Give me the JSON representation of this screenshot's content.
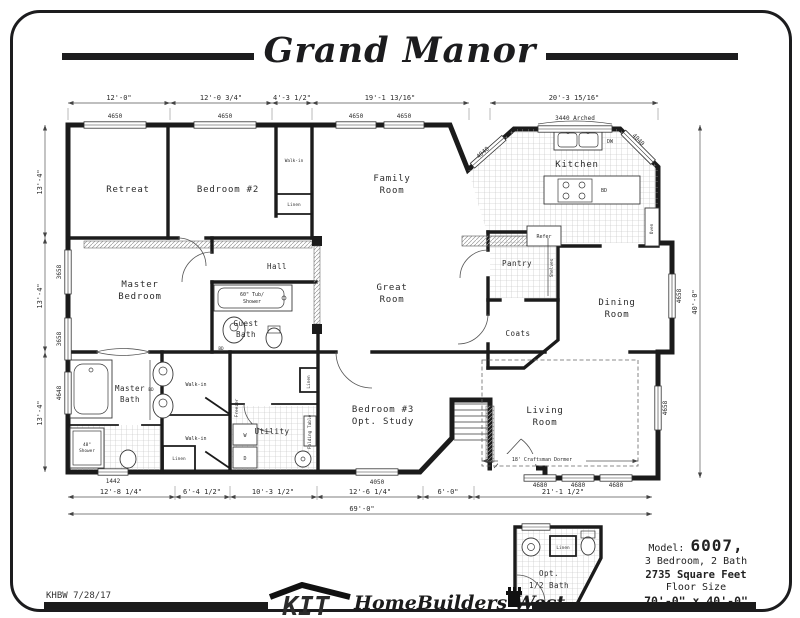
{
  "title": "Grand Manor",
  "footer": {
    "code": "KHBW 7/28/17",
    "brand": "KIT",
    "brand_name": "HomeBuilders West"
  },
  "info": {
    "model_label": "Model:",
    "model_number": "6007,",
    "line2": "3 Bedroom, 2 Bath",
    "line3": "2735 Square Feet",
    "line4": "Floor Size",
    "line5": "70'-0\" x 40'-0\""
  },
  "rooms": {
    "retreat": "Retreat",
    "bedroom2": "Bedroom #2",
    "family": [
      "Family",
      "Room"
    ],
    "kitchen": "Kitchen",
    "hall": "Hall",
    "master_bedroom": [
      "Master",
      "Bedroom"
    ],
    "guest_bath": [
      "Guest",
      "Bath"
    ],
    "great": [
      "Great",
      "Room"
    ],
    "pantry": "Pantry",
    "dining": [
      "Dining",
      "Room"
    ],
    "coats": "Coats",
    "master_bath": [
      "Master",
      "Bath"
    ],
    "utility": "Utility",
    "bedroom3": [
      "Bedroom #3",
      "Opt. Study"
    ],
    "living": [
      "Living",
      "Room"
    ],
    "half_bath": [
      "Opt.",
      "1/2 Bath"
    ]
  },
  "fixtures": {
    "walk_in": "Walk-in",
    "linen": "Linen",
    "refer": "Refer",
    "dw": "DW",
    "bd": "BD",
    "tub_label": [
      "60\" Tub/",
      "Shower"
    ],
    "shower_label": [
      "48\"",
      "Shower"
    ],
    "freezer": "Freezer",
    "folding_table": "Folding Table",
    "washer": "W",
    "dryer": "D",
    "shelves": "Shelves",
    "oven": "Oven",
    "dormer": "18' Craftsman Dormer",
    "arched": "3440 Arched"
  },
  "windows": {
    "w4650": "4650",
    "w4040": "4040",
    "w3658": "3658",
    "w4648": "4648",
    "w4658": "4658",
    "w4680": "4680",
    "w4050": "4050",
    "w1442": "1442"
  },
  "dims": {
    "top": [
      "12'-0\"",
      "12'-0 3/4\"",
      "4'-3 1/2\"",
      "19'-1 13/16\"",
      "20'-3 15/16\""
    ],
    "left_bay": "13'-4\"",
    "right_overall": "40'-0\"",
    "bottom": [
      "12'-8 1/4\"",
      "6'-4 1/2\"",
      "10'-3 1/2\"",
      "12'-6 1/4\"",
      "6'-0\"",
      "21'-1 1/2\""
    ],
    "overall_width": "69'-0\""
  }
}
